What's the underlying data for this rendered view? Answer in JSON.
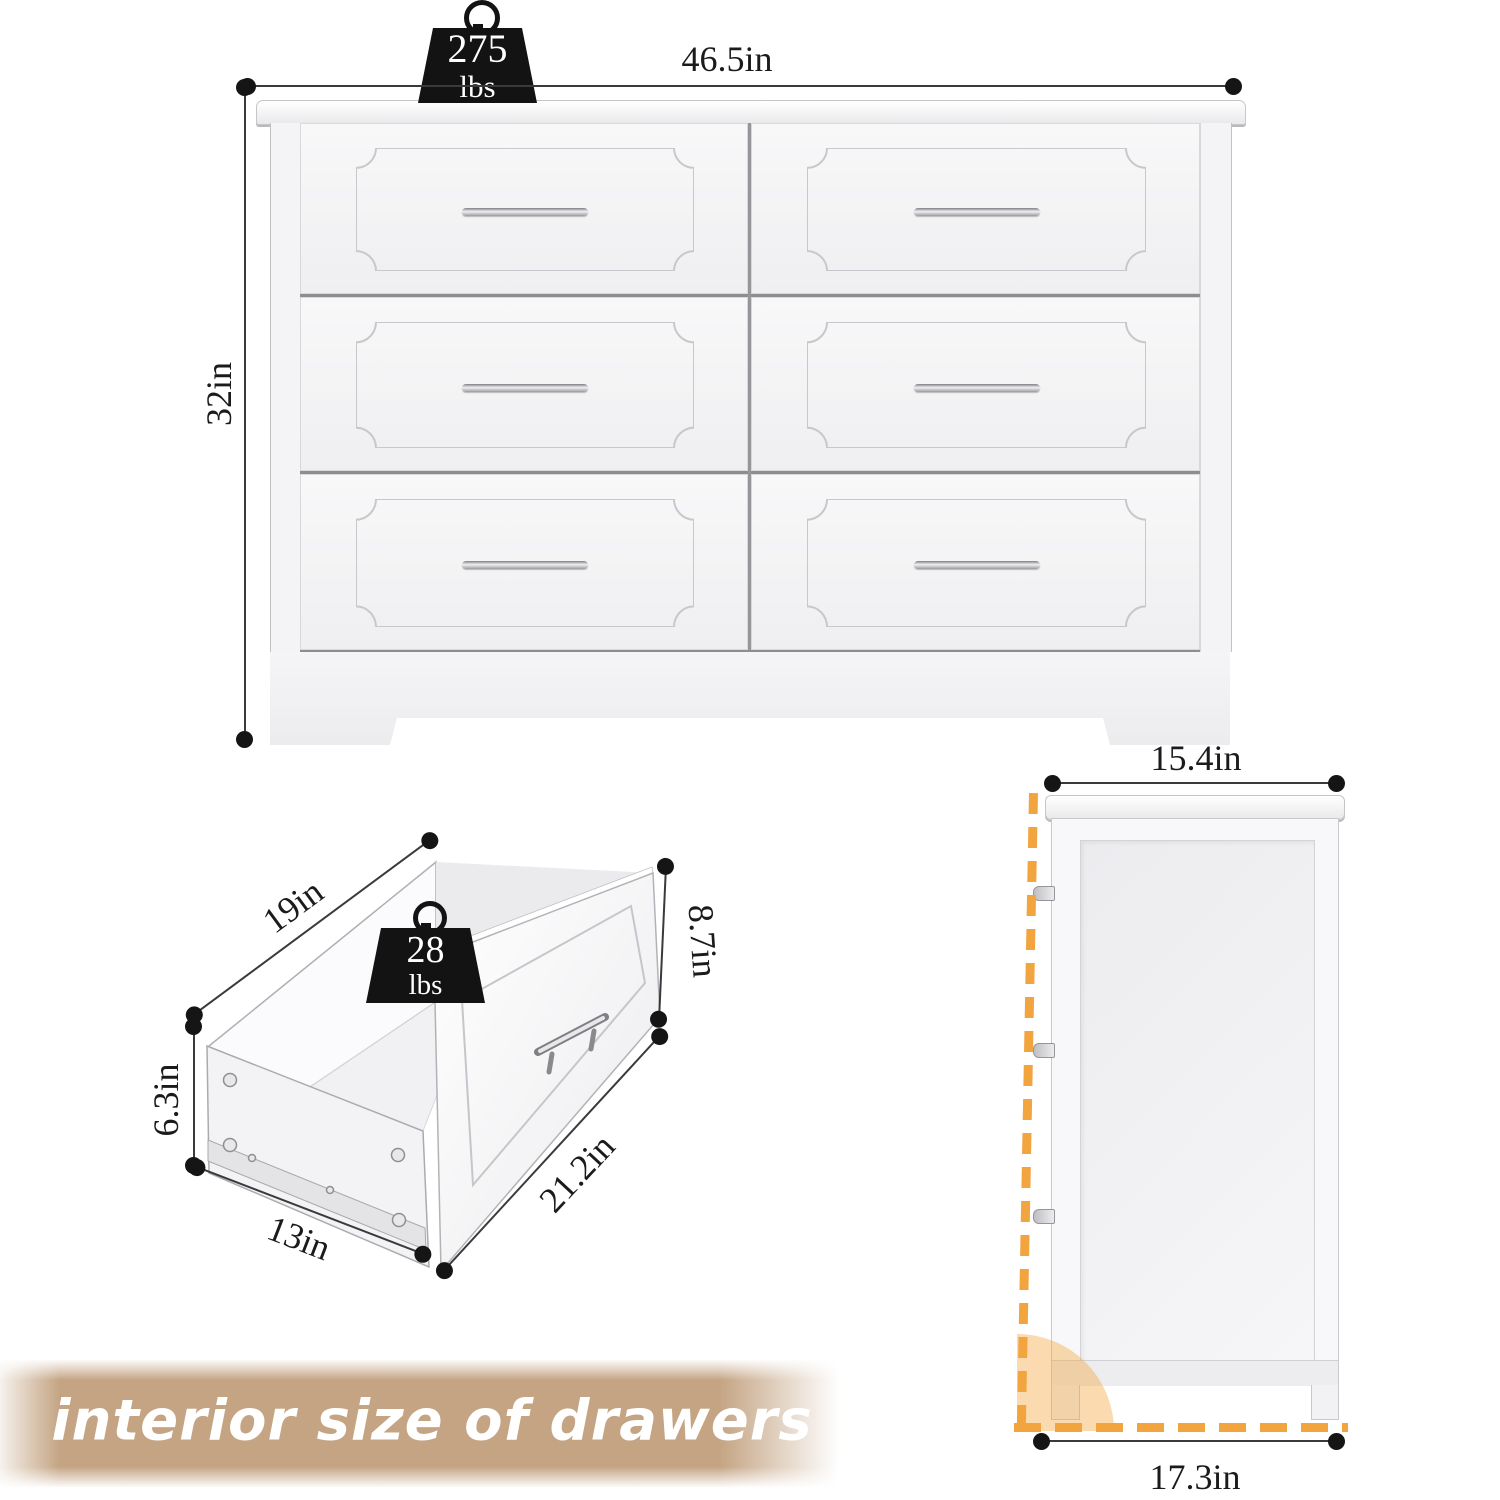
{
  "views": {
    "front": {
      "weight_capacity_value": "275",
      "weight_capacity_unit": "lbs",
      "width_label": "46.5in",
      "height_label": "32in"
    },
    "drawer": {
      "weight_capacity_value": "28",
      "weight_capacity_unit": "lbs",
      "interior_width_label": "19in",
      "interior_height_label": "6.3in",
      "interior_depth_label": "13in",
      "front_width_label": "21.2in",
      "front_height_label": "8.7in"
    },
    "side": {
      "top_depth_label": "15.4in",
      "bottom_depth_label": "17.3in"
    }
  },
  "caption": "interior size of drawers",
  "colors": {
    "dashed_outline_orange": "#F2A43E",
    "caption_banner_tan": "#C4A483",
    "weight_icon_black": "#131313"
  }
}
